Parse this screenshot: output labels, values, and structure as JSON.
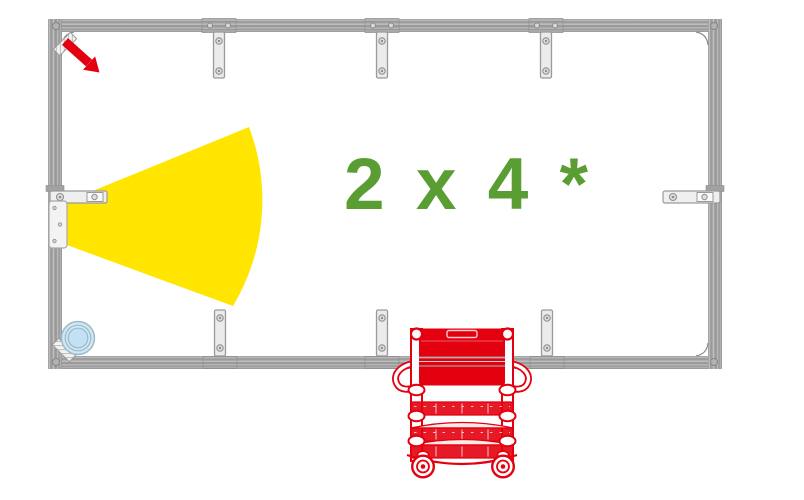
{
  "label": {
    "capacity": "2 x 4 *"
  },
  "colors": {
    "accent_red": "#e3000f",
    "beam_yellow": "#ffe500",
    "label_green": "#5a9e33",
    "wall_gray": "#9d9d9d",
    "drain_fill": "#cde8f7",
    "drain_stroke": "#9db7c5"
  },
  "elements": {
    "entrance_arrow_icon": "red-diagonal-arrow",
    "detection_beam": "yellow-fan-cone",
    "floor_drain_icon": "light-blue-concentric-circles",
    "equipment_cart": "red-service-trolley",
    "room_walls": "gray-aluminum-frame"
  }
}
